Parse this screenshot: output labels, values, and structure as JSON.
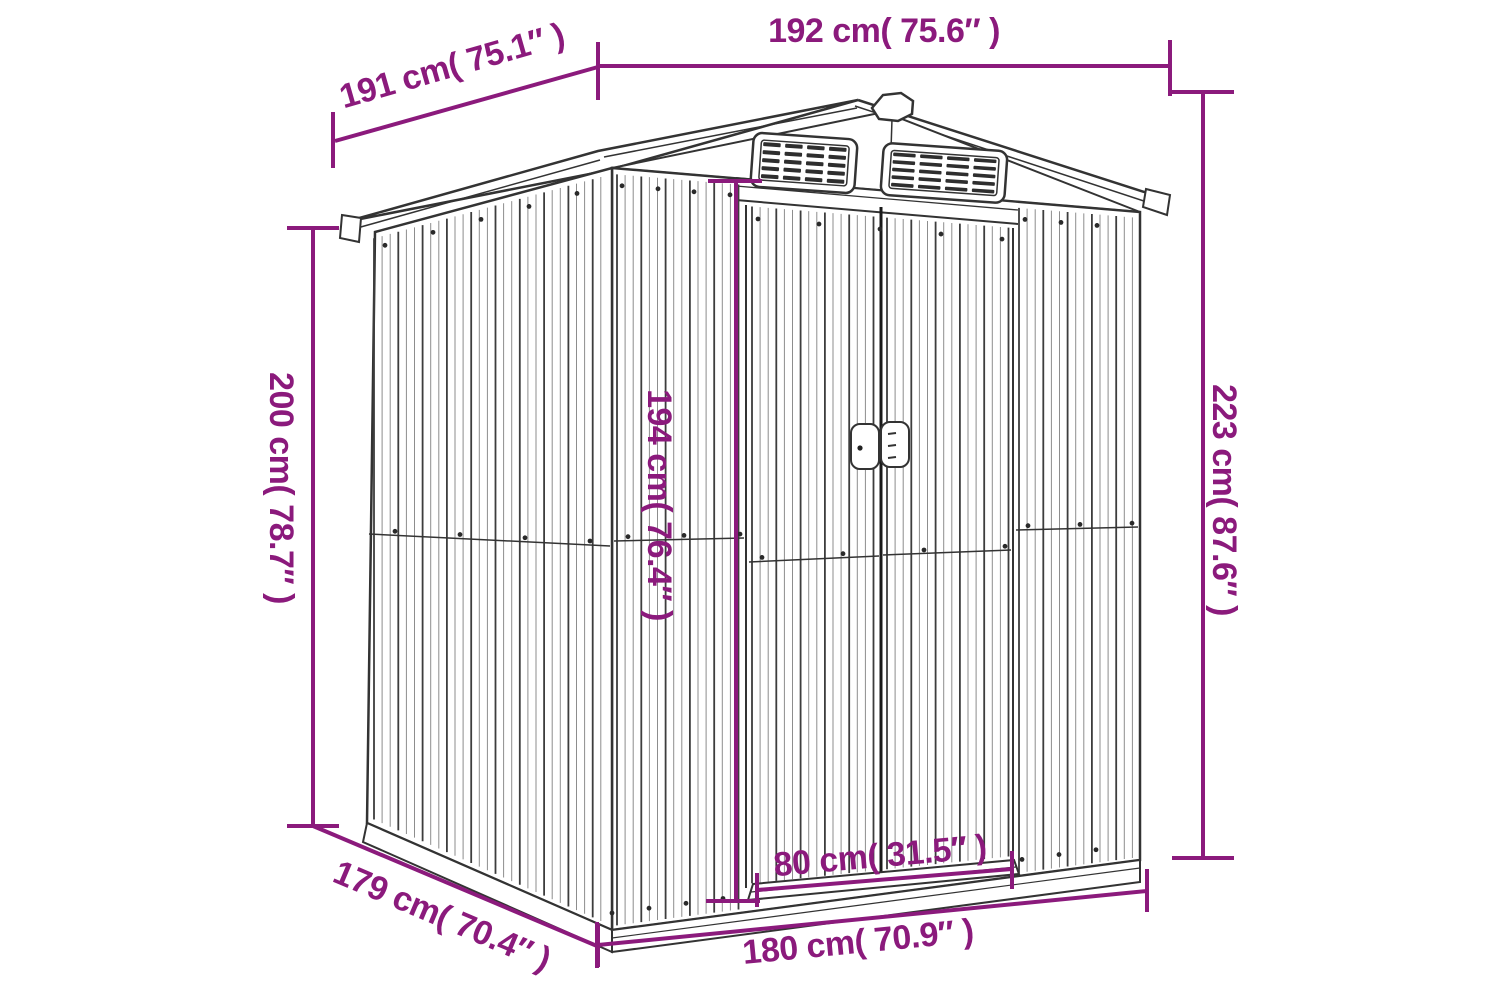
{
  "diagram": {
    "type": "product-dimension-diagram",
    "subject": "metal garden shed with gable roof, two louvered vents and sliding double doors",
    "accent_color": "#8B1A7C",
    "line_color": "#333333",
    "dimensions": {
      "roof_width": {
        "label": "192 cm( 75.6″ )"
      },
      "roof_depth": {
        "label": "191 cm( 75.1″ )"
      },
      "total_height": {
        "label": "223 cm( 87.6″ )"
      },
      "wall_height": {
        "label": "200 cm( 78.7″ )"
      },
      "door_height": {
        "label": "194 cm( 76.4″ )"
      },
      "door_width": {
        "label": "80 cm( 31.5″ )"
      },
      "base_depth": {
        "label": "179 cm( 70.4″ )"
      },
      "base_width": {
        "label": "180 cm( 70.9″ )"
      }
    }
  }
}
